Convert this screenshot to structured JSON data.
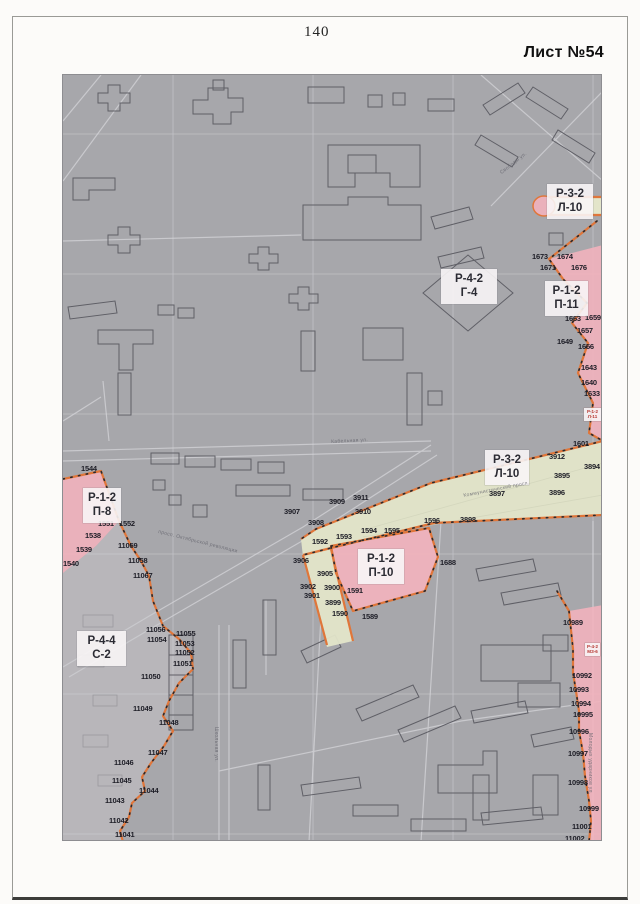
{
  "page": {
    "number": "140",
    "sheet_label": "Лист №54"
  },
  "colors": {
    "map_background": "#a7a7ab",
    "zone_pink": "#f2b3bd",
    "street_zone_yellow": "#e3e5c9",
    "boundary_orange": "#e0763a",
    "boundary_dots_black": "#2a2a2e",
    "building_outline": "#5f5f66",
    "street_line": "#c9c9cd",
    "label_box_white": "#f8f5f6",
    "tiny_label_red": "#b5352f",
    "light_zone_gray": "#b8b6ba"
  },
  "map": {
    "zone_boxes": [
      {
        "lines": [
          "Р-3-2",
          "Л-10"
        ],
        "x": 546,
        "y": 183,
        "w": 42
      },
      {
        "lines": [
          "Р-4-2",
          "Г-4"
        ],
        "x": 440,
        "y": 268,
        "w": 52
      },
      {
        "lines": [
          "Р-1-2",
          "П-11"
        ],
        "x": 544,
        "y": 280,
        "w": 39
      },
      {
        "lines": [
          "Р-3-2",
          "Л-10"
        ],
        "x": 484,
        "y": 449,
        "w": 40
      },
      {
        "lines": [
          "Р-1-2",
          "П-8"
        ],
        "x": 82,
        "y": 487,
        "w": 34
      },
      {
        "lines": [
          "Р-1-2",
          "П-10"
        ],
        "x": 357,
        "y": 548,
        "w": 42
      },
      {
        "lines": [
          "Р-4-4",
          "С-2"
        ],
        "x": 76,
        "y": 630,
        "w": 45
      },
      {
        "lines": [
          "Р-1-2",
          "Л-11"
        ],
        "x": 583,
        "y": 407,
        "w": 17,
        "cls": "tiny"
      },
      {
        "lines": [
          "Р-4-2",
          "МЗ-6"
        ],
        "x": 584,
        "y": 642,
        "w": 15,
        "cls": "tiny"
      }
    ],
    "parcel_labels": [
      {
        "t": "1673",
        "x": 531,
        "y": 252
      },
      {
        "t": "1674",
        "x": 556,
        "y": 252
      },
      {
        "t": "1671",
        "x": 539,
        "y": 263
      },
      {
        "t": "1676",
        "x": 570,
        "y": 263
      },
      {
        "t": "1663",
        "x": 564,
        "y": 314
      },
      {
        "t": "1659",
        "x": 584,
        "y": 313
      },
      {
        "t": "1657",
        "x": 576,
        "y": 326
      },
      {
        "t": "1649",
        "x": 556,
        "y": 337
      },
      {
        "t": "1656",
        "x": 577,
        "y": 342
      },
      {
        "t": "1643",
        "x": 580,
        "y": 363
      },
      {
        "t": "1640",
        "x": 580,
        "y": 378
      },
      {
        "t": "1633",
        "x": 583,
        "y": 389
      },
      {
        "t": "1601",
        "x": 572,
        "y": 439
      },
      {
        "t": "3912",
        "x": 548,
        "y": 452
      },
      {
        "t": "3894",
        "x": 583,
        "y": 462
      },
      {
        "t": "3895",
        "x": 553,
        "y": 471
      },
      {
        "t": "3897",
        "x": 488,
        "y": 489
      },
      {
        "t": "3896",
        "x": 548,
        "y": 488
      },
      {
        "t": "3898",
        "x": 459,
        "y": 515
      },
      {
        "t": "3909",
        "x": 328,
        "y": 497
      },
      {
        "t": "3911",
        "x": 352,
        "y": 493
      },
      {
        "t": "3907",
        "x": 283,
        "y": 507
      },
      {
        "t": "3910",
        "x": 354,
        "y": 507
      },
      {
        "t": "3908",
        "x": 307,
        "y": 518
      },
      {
        "t": "1596",
        "x": 423,
        "y": 516
      },
      {
        "t": "1594",
        "x": 360,
        "y": 526
      },
      {
        "t": "1595",
        "x": 383,
        "y": 526
      },
      {
        "t": "1593",
        "x": 335,
        "y": 532
      },
      {
        "t": "1592",
        "x": 311,
        "y": 537
      },
      {
        "t": "3906",
        "x": 292,
        "y": 556
      },
      {
        "t": "3905",
        "x": 316,
        "y": 569
      },
      {
        "t": "3902",
        "x": 299,
        "y": 582
      },
      {
        "t": "3900",
        "x": 323,
        "y": 583
      },
      {
        "t": "3901",
        "x": 303,
        "y": 591
      },
      {
        "t": "3899",
        "x": 324,
        "y": 598
      },
      {
        "t": "1591",
        "x": 346,
        "y": 586
      },
      {
        "t": "1590",
        "x": 331,
        "y": 609
      },
      {
        "t": "1589",
        "x": 361,
        "y": 612
      },
      {
        "t": "1688",
        "x": 439,
        "y": 558
      },
      {
        "t": "1544",
        "x": 80,
        "y": 464
      },
      {
        "t": "1551",
        "x": 97,
        "y": 519
      },
      {
        "t": "1552",
        "x": 118,
        "y": 519
      },
      {
        "t": "1538",
        "x": 84,
        "y": 531
      },
      {
        "t": "1539",
        "x": 75,
        "y": 545
      },
      {
        "t": "1540",
        "x": 62,
        "y": 559
      },
      {
        "t": "11059",
        "x": 117,
        "y": 541
      },
      {
        "t": "11058",
        "x": 127,
        "y": 556
      },
      {
        "t": "11067",
        "x": 132,
        "y": 571
      },
      {
        "t": "11056",
        "x": 145,
        "y": 625
      },
      {
        "t": "11055",
        "x": 175,
        "y": 629
      },
      {
        "t": "11054",
        "x": 146,
        "y": 635
      },
      {
        "t": "11053",
        "x": 174,
        "y": 639
      },
      {
        "t": "11052",
        "x": 174,
        "y": 648
      },
      {
        "t": "11051",
        "x": 172,
        "y": 659
      },
      {
        "t": "11050",
        "x": 140,
        "y": 672
      },
      {
        "t": "11049",
        "x": 132,
        "y": 704
      },
      {
        "t": "11048",
        "x": 158,
        "y": 718
      },
      {
        "t": "11047",
        "x": 147,
        "y": 748
      },
      {
        "t": "11046",
        "x": 113,
        "y": 758
      },
      {
        "t": "11045",
        "x": 111,
        "y": 776
      },
      {
        "t": "11044",
        "x": 138,
        "y": 786
      },
      {
        "t": "11043",
        "x": 104,
        "y": 796
      },
      {
        "t": "11042",
        "x": 108,
        "y": 816
      },
      {
        "t": "11041",
        "x": 114,
        "y": 830
      },
      {
        "t": "10989",
        "x": 562,
        "y": 618
      },
      {
        "t": "10992",
        "x": 571,
        "y": 671
      },
      {
        "t": "10993",
        "x": 568,
        "y": 685
      },
      {
        "t": "10994",
        "x": 570,
        "y": 699
      },
      {
        "t": "10995",
        "x": 572,
        "y": 710
      },
      {
        "t": "10996",
        "x": 568,
        "y": 727
      },
      {
        "t": "10997",
        "x": 567,
        "y": 749
      },
      {
        "t": "10998",
        "x": 567,
        "y": 778
      },
      {
        "t": "10999",
        "x": 578,
        "y": 804
      },
      {
        "t": "11001",
        "x": 571,
        "y": 822
      },
      {
        "t": "11002",
        "x": 564,
        "y": 834
      }
    ],
    "street_labels": [
      {
        "t": "Кабельная ул.",
        "x": 330,
        "y": 438,
        "rot": -3
      },
      {
        "t": "Коммунистический просп.",
        "x": 462,
        "y": 492,
        "rot": -11
      },
      {
        "t": "просп. Октябрьской революции",
        "x": 158,
        "y": 528,
        "rot": 14
      },
      {
        "t": "Молодых ударников ул.",
        "x": 592,
        "y": 732,
        "rot": 90
      },
      {
        "t": "Школьная ул.",
        "x": 218,
        "y": 726,
        "rot": 90
      },
      {
        "t": "Свободы ул.",
        "x": 498,
        "y": 170,
        "rot": -38
      }
    ]
  }
}
